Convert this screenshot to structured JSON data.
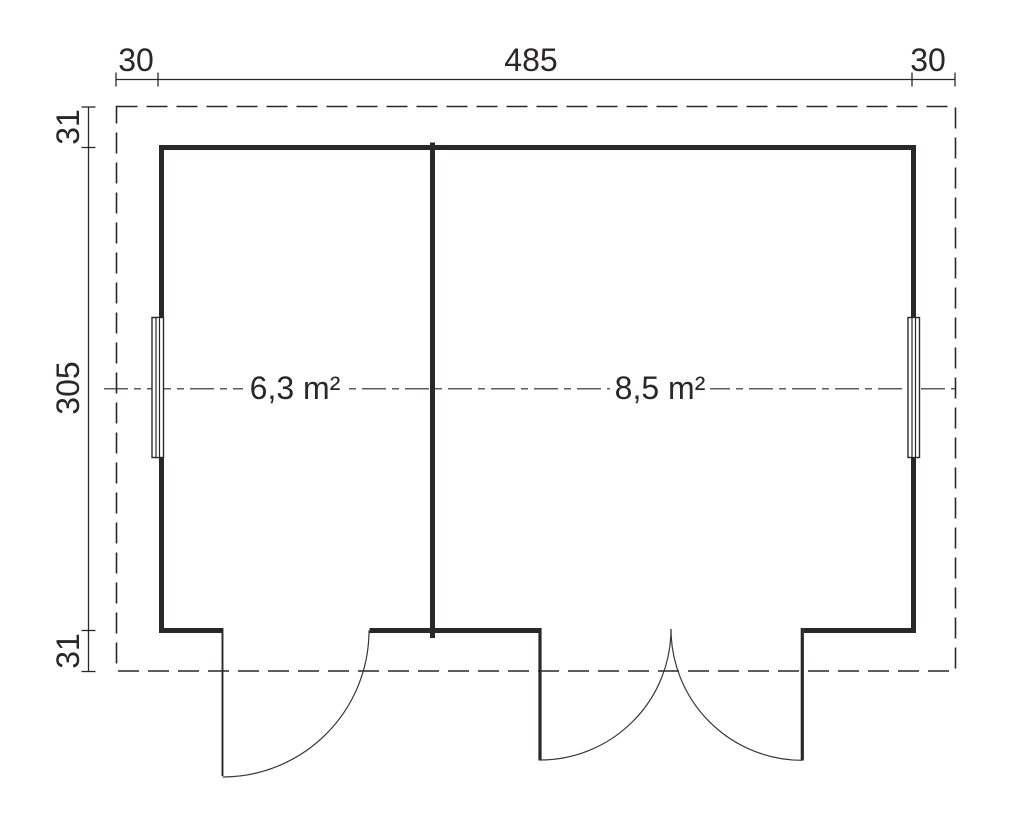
{
  "colors": {
    "line": "#2b2728",
    "background": "#ffffff"
  },
  "dimensions": {
    "top": {
      "left_overhang": "30",
      "building_width": "485",
      "right_overhang": "30"
    },
    "side": {
      "top_overhang": "31",
      "building_depth": "305",
      "bottom_overhang": "31"
    }
  },
  "rooms": {
    "left": {
      "area_label": "6,3 m²"
    },
    "right": {
      "area_label": "8,5 m²"
    }
  }
}
